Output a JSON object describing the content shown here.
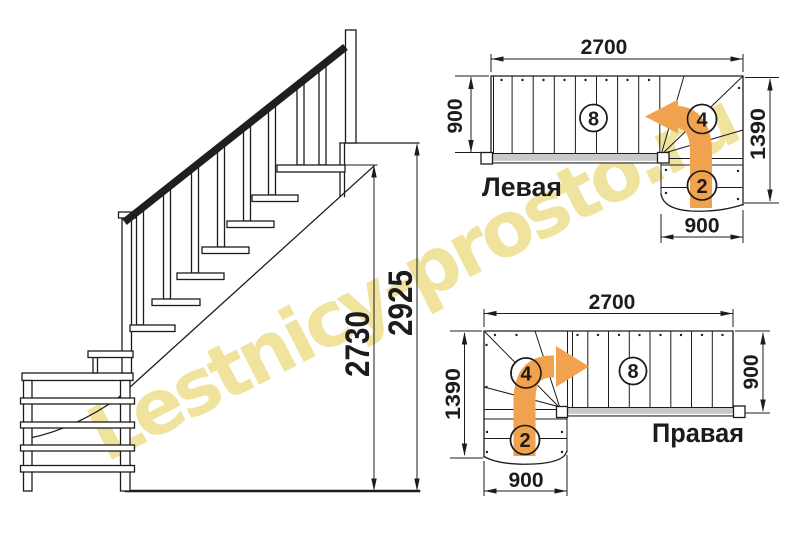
{
  "watermark": {
    "text": "Lestnicy-prosto.ru"
  },
  "colors": {
    "ink": "#1c1c1c",
    "orange": "#f1a24f",
    "tread_gray": "#c9c9c9",
    "watermark": "#efe093"
  },
  "side_view": {
    "height_total": "2925",
    "height_flight": "2730"
  },
  "plan_top": {
    "title": "Левая",
    "dim_top": "2700",
    "dim_left": "900",
    "dim_right": "1390",
    "dim_bottom": "900",
    "flight_steps": "8",
    "winder_steps": "4",
    "start_steps": "2"
  },
  "plan_bottom": {
    "title": "Правая",
    "dim_top": "2700",
    "dim_left": "1390",
    "dim_right": "900",
    "dim_bottom": "900",
    "flight_steps": "8",
    "winder_steps": "4",
    "start_steps": "2"
  }
}
